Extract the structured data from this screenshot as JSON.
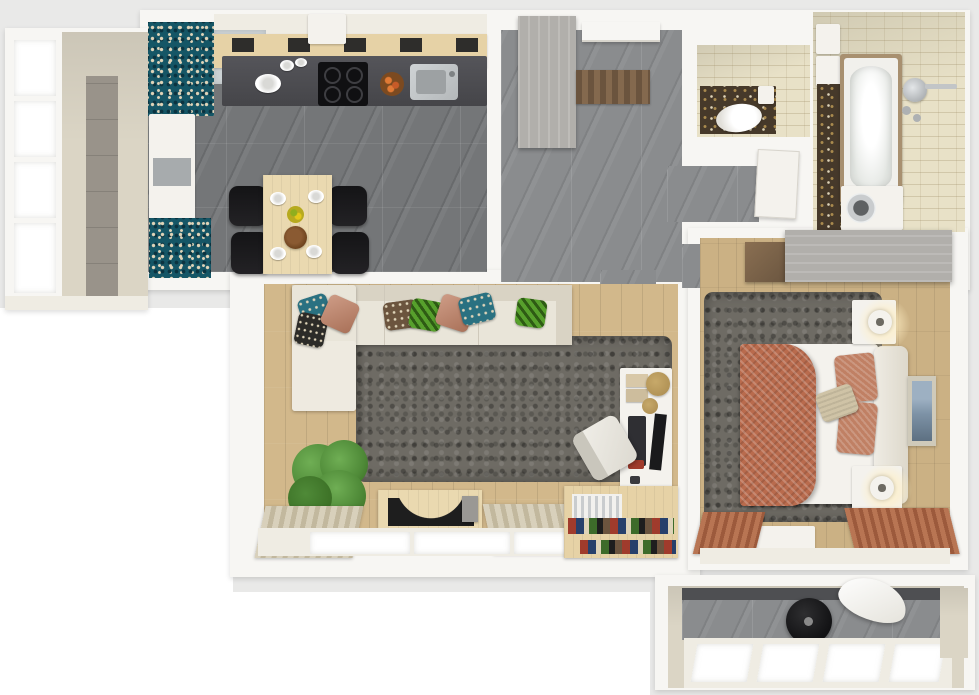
{
  "scene": {
    "title": "3D rendered top-view apartment floor plan",
    "rooms": [
      {
        "id": "balcony-left",
        "label": "Balcony"
      },
      {
        "id": "kitchen",
        "label": "Kitchen and dining area"
      },
      {
        "id": "hallway",
        "label": "Entrance hall"
      },
      {
        "id": "wc",
        "label": "WC"
      },
      {
        "id": "closet",
        "label": "Storage closet"
      },
      {
        "id": "bathroom",
        "label": "Bathroom"
      },
      {
        "id": "bedroom",
        "label": "Bedroom"
      },
      {
        "id": "living-room",
        "label": "Living room"
      },
      {
        "id": "loggia",
        "label": "Bottom loggia"
      }
    ],
    "furniture": {
      "kitchen": [
        "counter with cooktop and sink",
        "range hood",
        "tall white cabinet",
        "dining table with four plates",
        "four black chairs",
        "fruit bowl",
        "bread bowl"
      ],
      "hallway": [
        "wardrobe",
        "entry door",
        "door mat"
      ],
      "wc": [
        "toilet",
        "mosaic floor"
      ],
      "bathroom": [
        "bathtub",
        "washing machine",
        "shower head",
        "wall shelves",
        "mosaic strip"
      ],
      "bedroom": [
        "double bed with terracotta blanket",
        "two nightstands with lamps",
        "wardrobe",
        "shag rug",
        "wall art",
        "bench",
        "terracotta curtains"
      ],
      "living_room": [
        "corner sofa with pillows",
        "shag rug",
        "potted plant",
        "tv stand with tv",
        "desk with monitor",
        "office chair",
        "bookshelf",
        "beige curtains"
      ],
      "loggia": [
        "black pouf",
        "white board",
        "window wall"
      ]
    }
  },
  "palette": {
    "canvas": "#ffffff",
    "margin": "#e9e9e8",
    "wall": "#f7f6f3",
    "cream": "#efece3",
    "beige_wall": "#dbd5c5",
    "tile_dark": "#747678",
    "tile_mid": "#8a8c8e",
    "wood_floor": "#d2b88b",
    "wood_bedroom": "#cbb184",
    "counter_wood": "#e6d2a6",
    "counter_dark": "#454549",
    "steel": "#b4b8ba",
    "teal_mosaic": "#155666",
    "teal_deep": "#0b3340",
    "mosaic_cream": "#ded3b8",
    "dark_mosaic": "#46392a",
    "gold": "#a98a4e",
    "table_wood": "#ead9b0",
    "chair_black": "#232225",
    "sofa": "#e9e5d9",
    "sofa_shade": "#d9d3c4",
    "rug": "#6e6b64",
    "pillow_teal": "#2a7181",
    "pillow_green": "#57a02c",
    "pillow_green_dark": "#2e5b14",
    "pillow_terra": "#c08064",
    "pillow_black": "#2c2b28",
    "blanket": "#b96b4d",
    "bed_white": "#f4f2ed",
    "wardrobe": "#b1afab",
    "plant": "#4f8a38",
    "plant_dark": "#35671f",
    "plant_light": "#6fae54",
    "tv_black": "#1e1e1e",
    "curtain": "#d8d0bb",
    "curtain_dark": "#c2b89e",
    "curtain_terra": "#b87553",
    "curtain_terra_dark": "#9c5a3c",
    "bath_tile": "#e8e1c7",
    "tub": "#f1f0ec",
    "tub_inner": "#e3e6e2",
    "mat": "#6b543e",
    "mat_light": "#84694e",
    "glow": "#fff3cd",
    "art_blue": "#7d92a6",
    "book_red": "#a03b2c",
    "book_blue": "#27406b",
    "book_green": "#3d6b2a",
    "glossy_panel": "#ccd2d4"
  }
}
